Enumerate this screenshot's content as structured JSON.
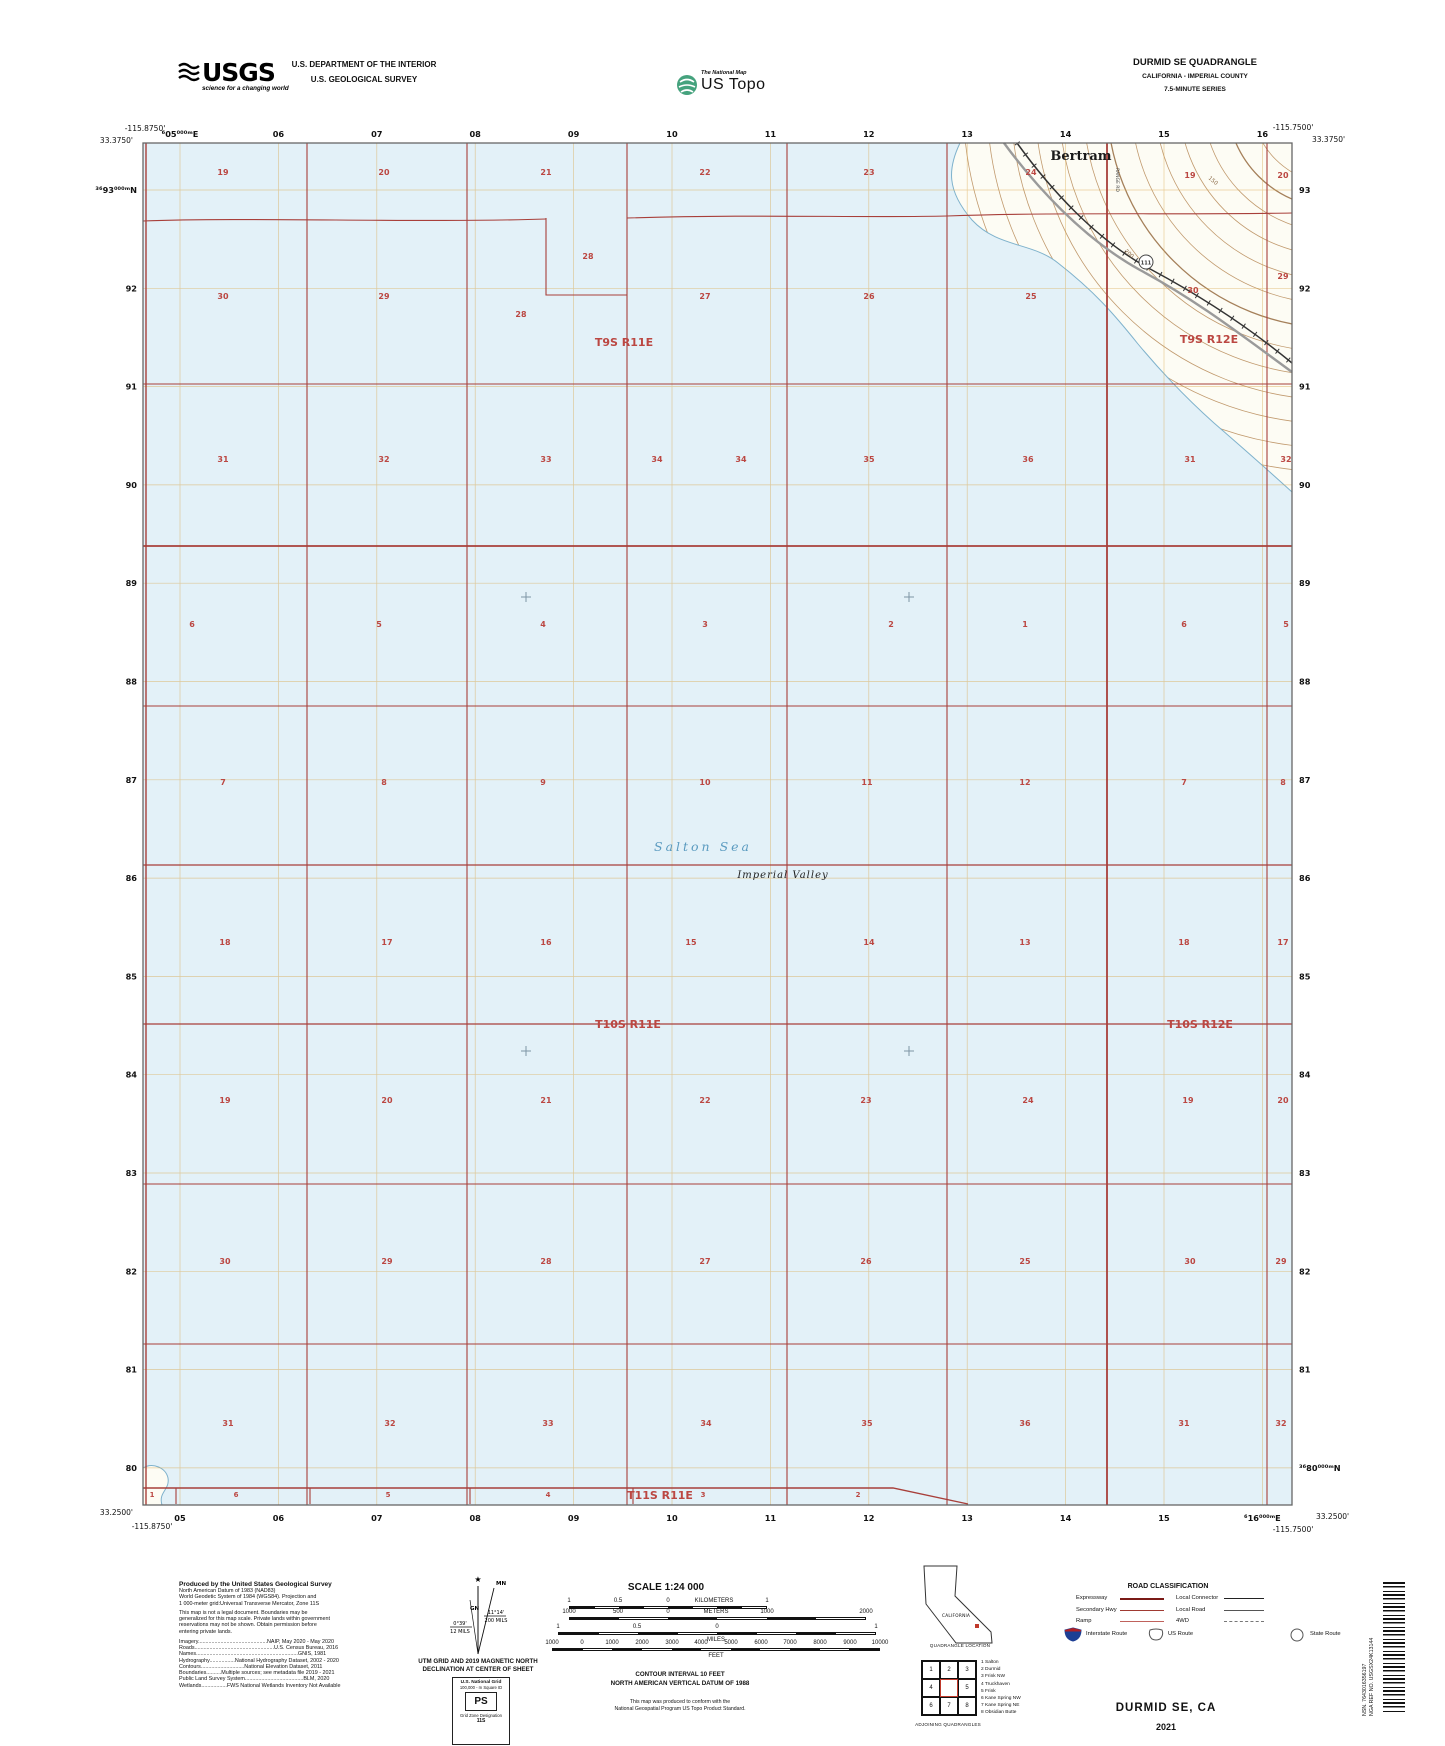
{
  "header": {
    "usgs_logo": {
      "acronym": "USGS",
      "tagline": "science for a changing world"
    },
    "dept_line1": "U.S. DEPARTMENT OF THE INTERIOR",
    "dept_line2": "U.S. GEOLOGICAL SURVEY",
    "ustopo": {
      "brand": "The National Map",
      "product": "US Topo"
    },
    "quad": {
      "title": "DURMID SE QUADRANGLE",
      "subtitle": "CALIFORNIA - IMPERIAL COUNTY",
      "series": "7.5-MINUTE SERIES"
    }
  },
  "map": {
    "corners": {
      "tl_lon": "-115.8750'",
      "tl_lat": "33.3750'",
      "tr_lon": "-115.7500'",
      "tr_lat": "33.3750'",
      "bl_lat": "33.2500'",
      "bl_lon": "-115.8750'",
      "br_lat": "33.2500'",
      "br_lon": "-115.7500'"
    },
    "top_edge_labels": [
      "⁶05⁰⁰⁰ᵐE",
      "06",
      "07",
      "08",
      "09",
      "10",
      "11",
      "12",
      "13",
      "14",
      "15",
      "16"
    ],
    "bottom_edge_labels": [
      "05",
      "06",
      "07",
      "08",
      "09",
      "10",
      "11",
      "12",
      "13",
      "14",
      "15",
      "⁶16⁰⁰⁰ᵐE"
    ],
    "left_edge_labels": [
      "³⁶93⁰⁰⁰ᵐN",
      "92",
      "91",
      "90",
      "89",
      "88",
      "87",
      "86",
      "85",
      "84",
      "83",
      "82",
      "81",
      "80"
    ],
    "right_edge_labels": [
      "93",
      "92",
      "91",
      "90",
      "89",
      "88",
      "87",
      "86",
      "85",
      "84",
      "83",
      "82",
      "81",
      "³⁶80⁰⁰⁰ᵐN"
    ],
    "township_labels": [
      {
        "text": "T9S R11E",
        "x": 624,
        "y": 346
      },
      {
        "text": "T9S R12E",
        "x": 1209,
        "y": 343
      },
      {
        "text": "T10S R11E",
        "x": 628,
        "y": 1028
      },
      {
        "text": "T10S R12E",
        "x": 1200,
        "y": 1028
      },
      {
        "text": "T11S R11E",
        "x": 660,
        "y": 1499
      }
    ],
    "place_labels": {
      "town": "Bertram",
      "sea": "Salton Sea",
      "valley": "Imperial Valley",
      "road": "RANGE RD"
    },
    "route_shield": "111",
    "contour_labels": [
      {
        "text": "150",
        "x": 1212,
        "y": 182,
        "rot": 40
      },
      {
        "text": "200",
        "x": 1128,
        "y": 255,
        "rot": 42
      }
    ],
    "section_numbers": [
      [
        "19",
        223,
        175
      ],
      [
        "20",
        384,
        175
      ],
      [
        "21",
        546,
        175
      ],
      [
        "22",
        705,
        175
      ],
      [
        "23",
        869,
        175
      ],
      [
        "24",
        1031,
        175
      ],
      [
        "19",
        1190,
        178
      ],
      [
        "20",
        1283,
        178
      ],
      [
        "28",
        588,
        259
      ],
      [
        "30",
        223,
        299
      ],
      [
        "29",
        384,
        299
      ],
      [
        "28",
        521,
        317
      ],
      [
        "27",
        705,
        299
      ],
      [
        "26",
        869,
        299
      ],
      [
        "25",
        1031,
        299
      ],
      [
        "30",
        1193,
        293
      ],
      [
        "29",
        1283,
        279
      ],
      [
        "31",
        223,
        462
      ],
      [
        "32",
        384,
        462
      ],
      [
        "33",
        546,
        462
      ],
      [
        "34",
        657,
        462
      ],
      [
        "34",
        741,
        462
      ],
      [
        "35",
        869,
        462
      ],
      [
        "36",
        1028,
        462
      ],
      [
        "31",
        1190,
        462
      ],
      [
        "32",
        1286,
        462
      ],
      [
        "6",
        192,
        627
      ],
      [
        "5",
        379,
        627
      ],
      [
        "4",
        543,
        627
      ],
      [
        "3",
        705,
        627
      ],
      [
        "2",
        891,
        627
      ],
      [
        "1",
        1025,
        627
      ],
      [
        "6",
        1184,
        627
      ],
      [
        "5",
        1286,
        627
      ],
      [
        "7",
        223,
        785
      ],
      [
        "8",
        384,
        785
      ],
      [
        "9",
        543,
        785
      ],
      [
        "10",
        705,
        785
      ],
      [
        "11",
        867,
        785
      ],
      [
        "12",
        1025,
        785
      ],
      [
        "7",
        1184,
        785
      ],
      [
        "8",
        1283,
        785
      ],
      [
        "18",
        225,
        945
      ],
      [
        "17",
        387,
        945
      ],
      [
        "16",
        546,
        945
      ],
      [
        "15",
        691,
        945
      ],
      [
        "14",
        869,
        945
      ],
      [
        "13",
        1025,
        945
      ],
      [
        "18",
        1184,
        945
      ],
      [
        "17",
        1283,
        945
      ],
      [
        "19",
        225,
        1103
      ],
      [
        "20",
        387,
        1103
      ],
      [
        "21",
        546,
        1103
      ],
      [
        "22",
        705,
        1103
      ],
      [
        "23",
        866,
        1103
      ],
      [
        "24",
        1028,
        1103
      ],
      [
        "19",
        1188,
        1103
      ],
      [
        "20",
        1283,
        1103
      ],
      [
        "30",
        225,
        1264
      ],
      [
        "29",
        387,
        1264
      ],
      [
        "28",
        546,
        1264
      ],
      [
        "27",
        705,
        1264
      ],
      [
        "26",
        866,
        1264
      ],
      [
        "25",
        1025,
        1264
      ],
      [
        "30",
        1190,
        1264
      ],
      [
        "29",
        1281,
        1264
      ],
      [
        "31",
        228,
        1426
      ],
      [
        "32",
        390,
        1426
      ],
      [
        "33",
        548,
        1426
      ],
      [
        "34",
        706,
        1426
      ],
      [
        "35",
        867,
        1426
      ],
      [
        "36",
        1025,
        1426
      ],
      [
        "31",
        1184,
        1426
      ],
      [
        "32",
        1281,
        1426
      ],
      [
        "1",
        152,
        1497
      ],
      [
        "6",
        236,
        1497
      ],
      [
        "5",
        388,
        1497
      ],
      [
        "4",
        548,
        1497
      ],
      [
        "3",
        703,
        1497
      ],
      [
        "2",
        858,
        1497
      ]
    ],
    "colors": {
      "water": "#e3f1f8",
      "land": "#fdfcf4",
      "grid_orange": "#d9a74c",
      "section_red": "#a83f3a",
      "label_red": "#bb4742",
      "contour": "#c19a6e"
    }
  },
  "footer": {
    "credits": {
      "heading": "Produced by the United States Geological Survey",
      "datum_lines": [
        "North American Datum of 1983 (NAD83)",
        "World Geodetic System of 1984 (WGS84).  Projection and",
        "1 000-meter grid:Universal Transverse Mercator, Zone 11S"
      ],
      "legal_lines": [
        "This map is not a legal document. Boundaries may be",
        "generalized for this map scale. Private lands within government",
        "reservations may not be shown. Obtain permission before",
        "entering private lands."
      ],
      "source_lines": [
        "Imagery..............................................NAIP, May 2020 - May 2020",
        "Roads.....................................................U.S. Census Bureau, 2016",
        "Names....................................................................GNIS, 1981",
        "Hydrography.................National Hydrography Dataset, 2002 - 2020",
        "Contours.............................National Elevation Dataset, 2011",
        "Boundaries..........Multiple sources; see metadata file 2019 - 2021",
        "Public Land Survey System.......................................BLM, 2020",
        "Wetlands.................FWS National Wetlands Inventory Not Available"
      ]
    },
    "declination": {
      "mn": "MN",
      "gn": "GN",
      "left_deg": "0°39'",
      "left_mils": "12 MILS",
      "right_deg": "11°14'",
      "right_mils": "200 MILS",
      "caption1": "UTM GRID AND 2019 MAGNETIC NORTH",
      "caption2": "DECLINATION AT CENTER OF SHEET"
    },
    "usng": {
      "title": "U.S. National Grid",
      "sub": "100,000 - m Square ID",
      "square": "PS",
      "zone_label": "Grid Zone Designation",
      "zone": "11S"
    },
    "scale": {
      "title": "SCALE 1:24 000",
      "km_labels": [
        [
          "1",
          569
        ],
        [
          "0.5",
          618
        ],
        [
          "0",
          668
        ],
        [
          "KILOMETERS",
          714
        ],
        [
          "1",
          767
        ]
      ],
      "m_labels": [
        [
          "1000",
          569
        ],
        [
          "500",
          618
        ],
        [
          "0",
          668
        ],
        [
          "METERS",
          716
        ],
        [
          "1000",
          767
        ],
        [
          "2000",
          866
        ]
      ],
      "mi_labels": [
        [
          "1",
          558
        ],
        [
          "0.5",
          637
        ],
        [
          "0",
          717
        ],
        [
          "1",
          876
        ]
      ],
      "mi_unit": "MILES",
      "ft_labels": [
        [
          "1000",
          552
        ],
        [
          "0",
          582
        ],
        [
          "1000",
          612
        ],
        [
          "2000",
          642
        ],
        [
          "3000",
          672
        ],
        [
          "4000",
          701
        ],
        [
          "5000",
          731
        ],
        [
          "6000",
          761
        ],
        [
          "7000",
          790
        ],
        [
          "8000",
          820
        ],
        [
          "9000",
          850
        ],
        [
          "10000",
          880
        ]
      ],
      "ft_unit": "FEET",
      "contour_note": [
        "CONTOUR INTERVAL 10 FEET",
        "NORTH AMERICAN VERTICAL DATUM OF 1988"
      ],
      "standard_note": [
        "This map was produced to conform with the",
        "National Geospatial Program US Topo Product Standard."
      ]
    },
    "location": {
      "state_label": "CALIFORNIA",
      "caption": "QUADRANGLE LOCATION"
    },
    "adjoining": {
      "caption": "ADJOINING QUADRANGLES",
      "cells": [
        "1",
        "2",
        "3",
        "4",
        "",
        "5",
        "6",
        "7",
        "8"
      ],
      "list": [
        "1 Salton",
        "2 Durmid",
        "3 Frink NW",
        "4 Truckhaven",
        "5 Frink",
        "6 Kane Spring NW",
        "7 Kane Spring NE",
        "8 Obsidian Butte"
      ]
    },
    "road_classification": {
      "title": "ROAD CLASSIFICATION",
      "rows": [
        {
          "label": "Expressway"
        },
        {
          "label": "Secondary Hwy"
        },
        {
          "label": "Ramp"
        }
      ],
      "rows_right": [
        {
          "label": "Local Connector"
        },
        {
          "label": "Local Road"
        },
        {
          "label": "4WD"
        }
      ],
      "shields": [
        {
          "label": "Interstate Route"
        },
        {
          "label": "US Route"
        },
        {
          "label": "State Route"
        }
      ]
    },
    "barcode": {
      "nsn": "NSN.  7643016356197",
      "nga": "NGA REF NO. USGSX24K13144"
    },
    "title_block": {
      "name": "DURMID SE,  CA",
      "year": "2021"
    }
  }
}
